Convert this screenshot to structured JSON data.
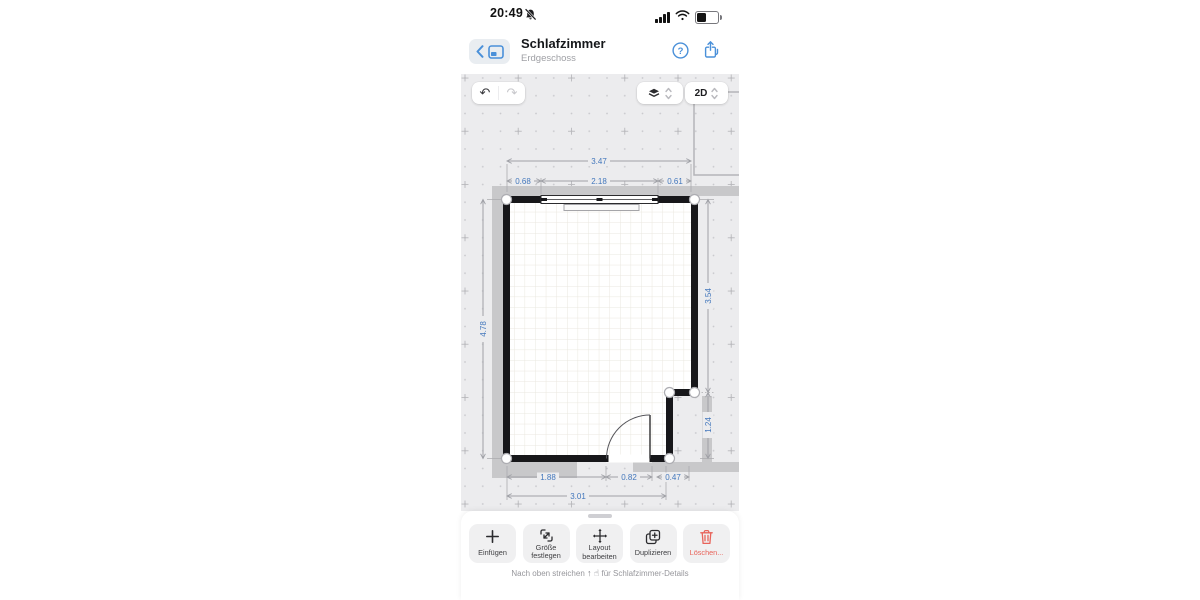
{
  "status_bar": {
    "time": "20:49"
  },
  "header": {
    "title": "Schlafzimmer",
    "subtitle": "Erdgeschoss"
  },
  "canvas_toolbar": {
    "view_mode": "2D"
  },
  "floorplan": {
    "dimensions": {
      "top_total": "3.47",
      "top_left": "0.68",
      "top_window": "2.18",
      "top_right": "0.61",
      "left_wall": "4.78",
      "right_upper": "3.54",
      "right_lower": "1.24",
      "bottom_left": "1.88",
      "bottom_door": "0.82",
      "bottom_right": "0.47",
      "bottom_total": "3.01"
    }
  },
  "bottom_toolbar": {
    "buttons": [
      {
        "id": "insert",
        "label": "Einfügen"
      },
      {
        "id": "set-size",
        "label": "Größe festlegen"
      },
      {
        "id": "edit-layout",
        "label": "Layout bearbeiten"
      },
      {
        "id": "duplicate",
        "label": "Duplizieren"
      },
      {
        "id": "delete",
        "label": "Löschen..."
      }
    ]
  },
  "footer_hint": {
    "prefix": "Nach oben streichen",
    "arrow": "↑",
    "hand": "☝",
    "suffix": "für Schlafzimmer-Details"
  },
  "colors": {
    "accent_blue": "#4A90D9",
    "dimension_blue": "#4377BC",
    "delete_red": "#E8635A",
    "canvas_gray": "#ECECEE",
    "wall_black": "#17171A",
    "exterior_band_gray": "#C8C8CA"
  }
}
